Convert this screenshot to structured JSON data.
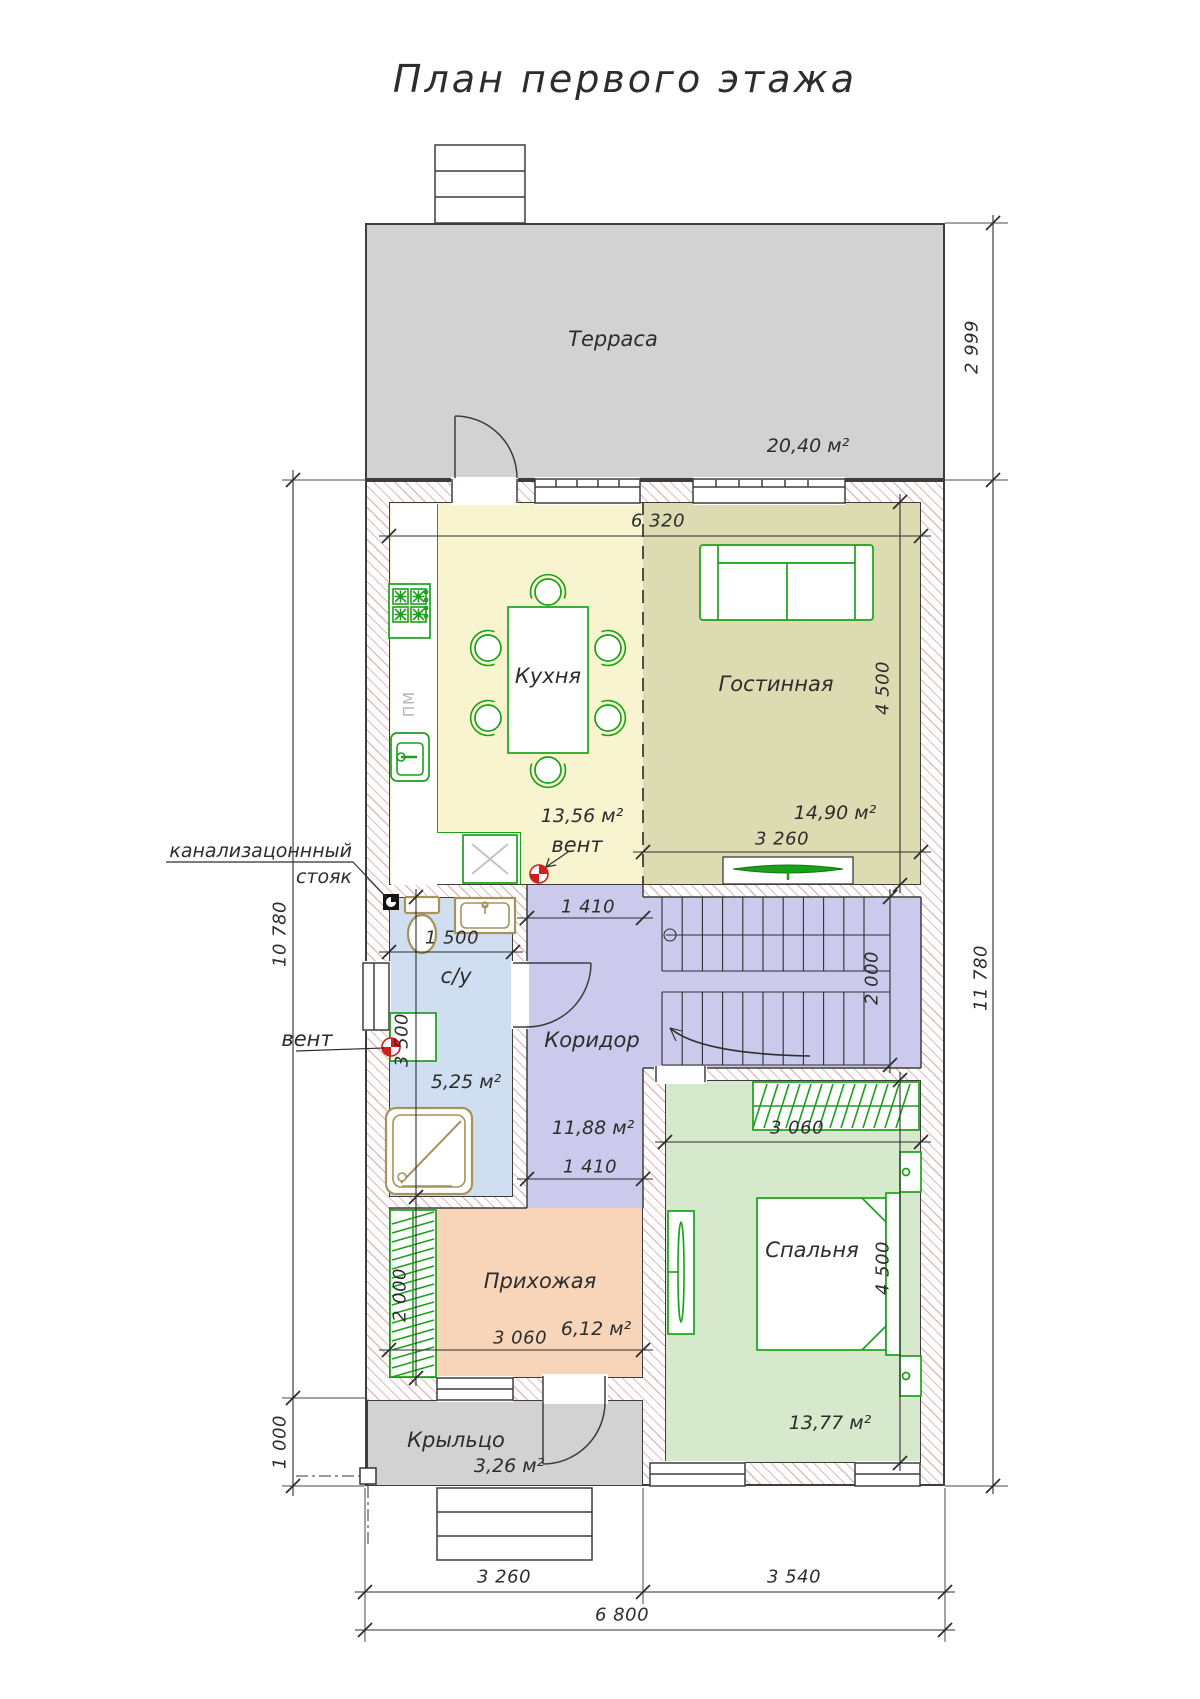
{
  "title": "План первого этажа",
  "rooms": {
    "terrace": {
      "label": "Терраса",
      "area": "20,40 м²"
    },
    "kitchen": {
      "label": "Кухня",
      "area": "13,56 м²"
    },
    "living": {
      "label": "Гостинная",
      "area": "14,90 м²"
    },
    "bathroom": {
      "label": "с/у",
      "area": "5,25 м²"
    },
    "corridor": {
      "label": "Коридор",
      "area": "11,88 м²"
    },
    "bedroom": {
      "label": "Спальня",
      "area": "13,77 м²"
    },
    "hallway": {
      "label": "Прихожая",
      "area": "6,12 м²"
    },
    "porch": {
      "label": "Крыльцо",
      "area": "3,26 м²"
    }
  },
  "annotations": {
    "sewer_line1": "канализацоннный",
    "sewer_line2": "стояк",
    "vent_bath": "вент",
    "vent_kitchen": "вент",
    "dishwasher": "ПМ"
  },
  "dimensions": {
    "interior_width": "6 320",
    "living_width": "3 260",
    "living_height": "4 500",
    "passage_top": "1 410",
    "bath_width": "1 500",
    "bath_height": "3 500",
    "stairs_depth": "2 000",
    "wardrobe_height": "2 000",
    "passage_bottom": "1 410",
    "bedroom_wardrobe_width": "3 060",
    "bedroom_height": "4 500",
    "hallway_width": "3 060",
    "terrace_depth": "2 999",
    "house_depth": "11 780",
    "left_depth": "10 780",
    "porch_depth": "1 000",
    "bottom_left": "3 260",
    "bottom_right": "3 540",
    "total_width": "6 800"
  },
  "colors": {
    "wall_line": "#3d3d3d",
    "hatch": "#cb8580",
    "terrace_fill": "#d2d2d2",
    "kitchen_fill": "#f8f4cf",
    "living_fill": "#dcdbb2",
    "corridor_fill": "#cbc9ec",
    "bathroom_fill": "#cfdff1",
    "bedroom_fill": "#d6e9cd",
    "hallway_fill": "#f8d5b9",
    "furniture_green": "#1aa11a",
    "sanitary_tan": "#a5925f",
    "vent_red": "#cf1f1f"
  }
}
